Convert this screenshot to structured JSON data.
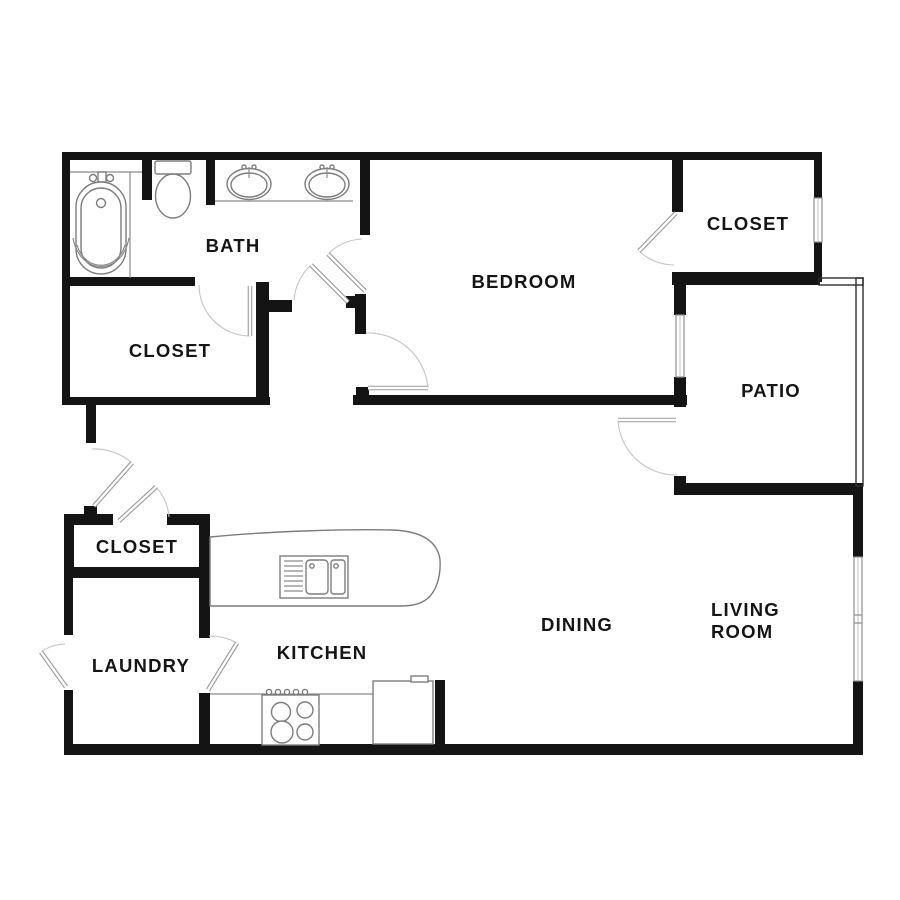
{
  "floor_plan": {
    "background": "#ffffff",
    "wall_color": "#141414",
    "fixture_color": "#7d7d7d",
    "door_color": "#b5b5b5",
    "label_color": "#151515",
    "rooms": {
      "bath": "BATH",
      "closet_master": "CLOSET",
      "bedroom": "BEDROOM",
      "closet_bedroom": "CLOSET",
      "patio": "PATIO",
      "closet_entry": "CLOSET",
      "laundry": "LAUNDRY",
      "kitchen": "KITCHEN",
      "dining": "DINING",
      "living_room_line1": "LIVING",
      "living_room_line2": "ROOM"
    },
    "fixtures": [
      "bathtub",
      "toilet",
      "double-vanity-sinks",
      "kitchen-island",
      "island-double-sink",
      "stove",
      "refrigerator",
      "patio-railing",
      "windows"
    ]
  }
}
